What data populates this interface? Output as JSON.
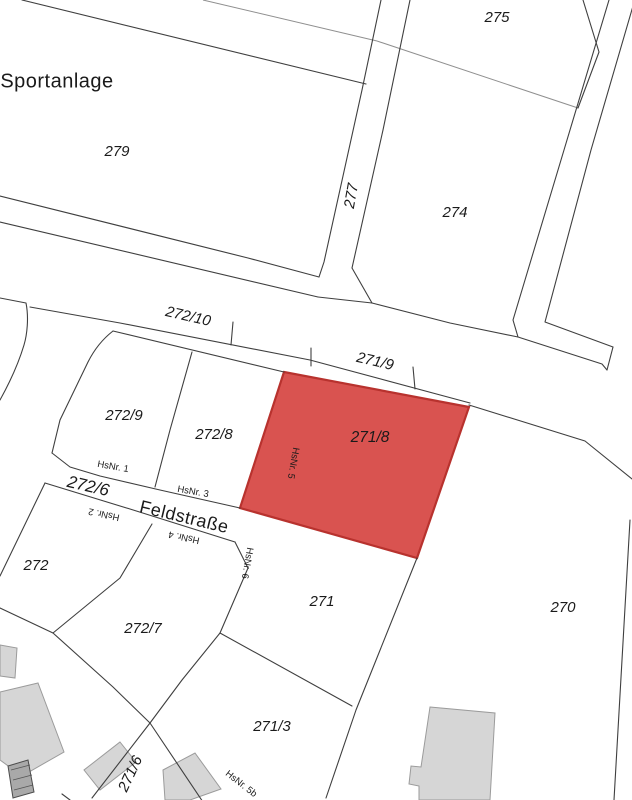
{
  "map": {
    "title": "Flurkarte (cadastral parcel map)",
    "area_label": "Sportanlage",
    "street_name": "Feldstraße",
    "highlighted_parcel": "271/8",
    "colors": {
      "background": "#ffffff",
      "boundary_line": "#3f3f3f",
      "boundary_line_light": "#8f8f8f",
      "building_fill": "#d6d6d6",
      "building_stroke": "#9b9b9b",
      "highlight_fill": "#d95350",
      "highlight_stroke": "#b8322e",
      "highlight_label": "#5f2020"
    },
    "labels": [
      {
        "text": "Sportanlage",
        "x": 57,
        "y": 82,
        "rot": 0,
        "kind": "area"
      },
      {
        "text": "279",
        "x": 117,
        "y": 152,
        "rot": 0,
        "kind": "parcel"
      },
      {
        "text": "275",
        "x": 497,
        "y": 18,
        "rot": 0,
        "kind": "parcel"
      },
      {
        "text": "277",
        "x": 352,
        "y": 196,
        "rot": -80,
        "kind": "parcel"
      },
      {
        "text": "274",
        "x": 455,
        "y": 213,
        "rot": 0,
        "kind": "parcel"
      },
      {
        "text": "272/10",
        "x": 188,
        "y": 317,
        "rot": 13,
        "kind": "parcel"
      },
      {
        "text": "271/9",
        "x": 375,
        "y": 362,
        "rot": 13,
        "kind": "parcel"
      },
      {
        "text": "272/9",
        "x": 124,
        "y": 416,
        "rot": 0,
        "kind": "parcel"
      },
      {
        "text": "272/8",
        "x": 214,
        "y": 435,
        "rot": 0,
        "kind": "parcel"
      },
      {
        "text": "271/8",
        "x": 370,
        "y": 438,
        "rot": 0,
        "kind": "highlight"
      },
      {
        "text": "HsNr. 1",
        "x": 113,
        "y": 467,
        "rot": 10,
        "kind": "house"
      },
      {
        "text": "HsNr. 3",
        "x": 193,
        "y": 492,
        "rot": 10,
        "kind": "house"
      },
      {
        "text": "272/6",
        "x": 88,
        "y": 487,
        "rot": 13,
        "kind": "parcel-big"
      },
      {
        "text": "Feldstraße",
        "x": 184,
        "y": 518,
        "rot": 13.5,
        "kind": "street"
      },
      {
        "text": "HsNr. 2",
        "x": 104,
        "y": 514,
        "rot": 192,
        "kind": "house"
      },
      {
        "text": "HsNr. 4",
        "x": 184,
        "y": 537,
        "rot": 192,
        "kind": "house"
      },
      {
        "text": "HsNr. 5",
        "x": 293,
        "y": 463,
        "rot": 100,
        "kind": "house"
      },
      {
        "text": "HsNr. 6",
        "x": 247,
        "y": 563,
        "rot": 100,
        "kind": "house"
      },
      {
        "text": "272",
        "x": 36,
        "y": 566,
        "rot": 0,
        "kind": "parcel"
      },
      {
        "text": "272/7",
        "x": 143,
        "y": 629,
        "rot": 0,
        "kind": "parcel"
      },
      {
        "text": "271",
        "x": 322,
        "y": 602,
        "rot": 0,
        "kind": "parcel"
      },
      {
        "text": "270",
        "x": 563,
        "y": 608,
        "rot": 0,
        "kind": "parcel"
      },
      {
        "text": "271/3",
        "x": 272,
        "y": 727,
        "rot": 0,
        "kind": "parcel"
      },
      {
        "text": "271/6",
        "x": 131,
        "y": 774,
        "rot": -65,
        "kind": "parcel"
      },
      {
        "text": "HsNr. 5b",
        "x": 241,
        "y": 784,
        "rot": 38,
        "kind": "house"
      }
    ]
  }
}
